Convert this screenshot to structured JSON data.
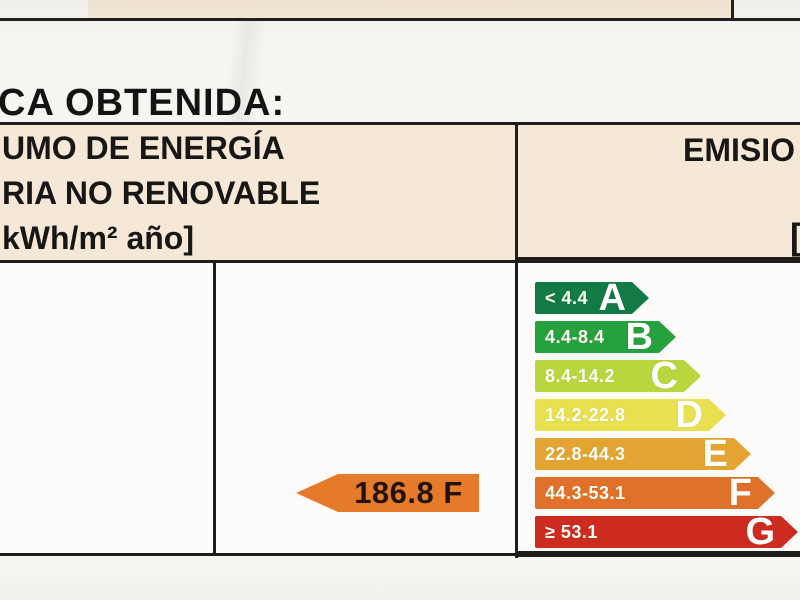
{
  "page": {
    "title": "CA OBTENIDA:"
  },
  "table": {
    "left_header": {
      "line1": "UMO DE ENERGÍA",
      "line2": "RIA NO RENOVABLE",
      "line3": "kWh/m² año]"
    },
    "right_header": {
      "title": "EMISIO",
      "bracket": "["
    },
    "result": {
      "value": "186.8 F",
      "color": "#e57a2b"
    },
    "scale": {
      "rows": [
        {
          "letter": "A",
          "range": "< 4.4",
          "color": "#117a45"
        },
        {
          "letter": "B",
          "range": "4.4-8.4",
          "color": "#25a23d"
        },
        {
          "letter": "C",
          "range": "8.4-14.2",
          "color": "#bad63e"
        },
        {
          "letter": "D",
          "range": "14.2-22.8",
          "color": "#e9e050"
        },
        {
          "letter": "E",
          "range": "22.8-44.3",
          "color": "#e3a431"
        },
        {
          "letter": "F",
          "range": "44.3-53.1",
          "color": "#e0712a"
        },
        {
          "letter": "G",
          "range": "≥ 53.1",
          "color": "#cd2b1f"
        }
      ]
    }
  },
  "colors": {
    "header_fill": "#f5e8d6",
    "border": "#1e1d1b",
    "body_fill": "#fdfcfa"
  }
}
